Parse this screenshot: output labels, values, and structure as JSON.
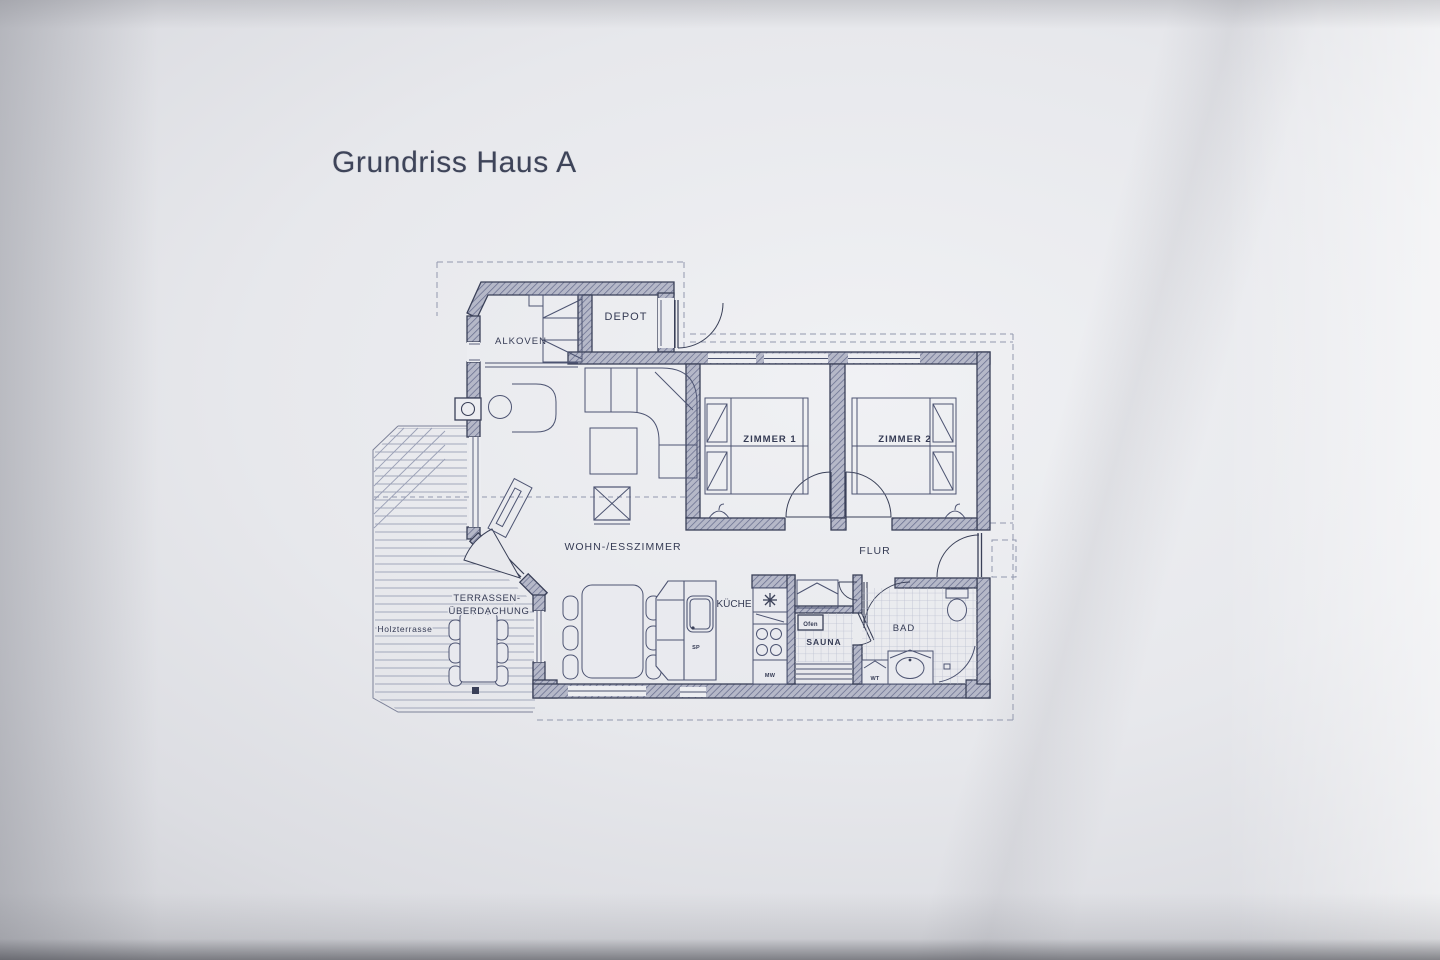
{
  "title": "Grundriss Haus A",
  "colors": {
    "paper": "#e7e8ec",
    "ink": "#3a4058",
    "wall_fill": "#b5b8c8",
    "wall_hatch": "#6a7090",
    "tile": "#bcc0d1",
    "dash": "#9298ae",
    "title_text": "#3e4459"
  },
  "rooms": {
    "alkoven": "ALKOVEN",
    "depot": "DEPOT",
    "zimmer1": "ZIMMER 1",
    "zimmer2": "ZIMMER 2",
    "wohn_esszimmer": "WOHN-/ESSZIMMER",
    "flur": "FLUR",
    "kueche": "KÜCHE",
    "sauna": "SAUNA",
    "bad": "BAD"
  },
  "outdoor": {
    "terrasse_line1": "TERRASSEN-",
    "terrasse_line2": "ÜBERDACHUNG",
    "holzterrasse": "Holzterrasse"
  },
  "fixtures": {
    "ofen": "Ofen",
    "wt": "WT",
    "sp": "SP",
    "mw": "MW"
  }
}
